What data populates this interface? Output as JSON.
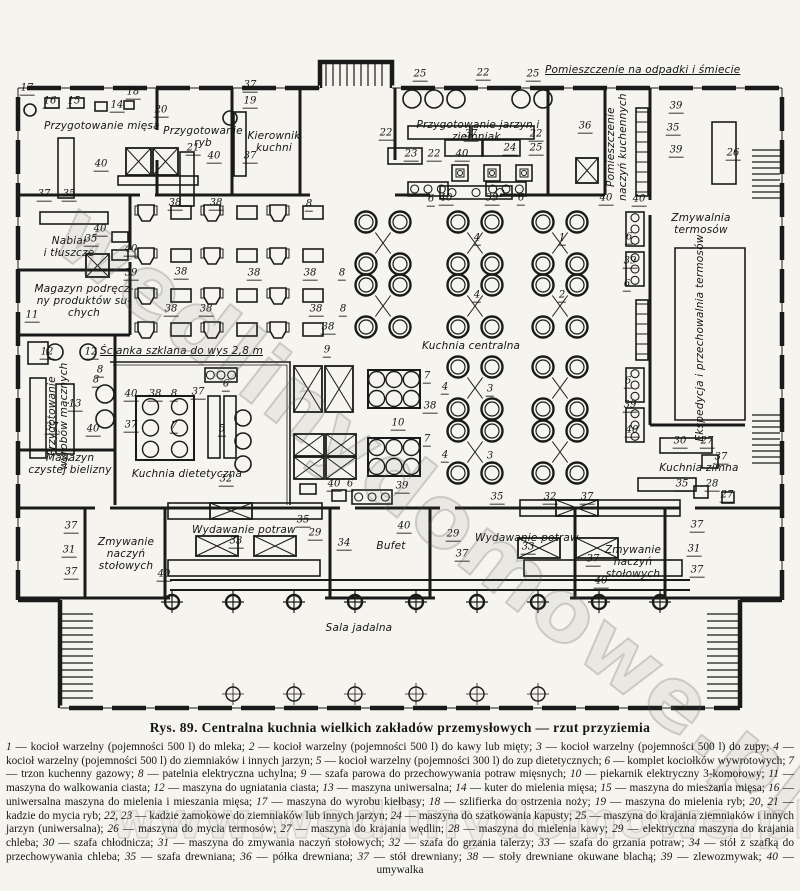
{
  "title_caption": "Rys. 89. Centralna kuchnia wielkich zakładów przemysłowych — rzut przyziemia",
  "watermarks": {
    "plan": "wedlinydomowe.pl",
    "legend": "www.wedlinydomowe.pl"
  },
  "labels": {
    "przygotowanie_miesa": "Przygotowanie mięsa",
    "przygotowanie_ryb": "Przygotowanie\nryb",
    "kierownik_kuchni": "Kierownik\nkuchni",
    "odpadki": "Pomieszczenie na odpadki i śmiecie",
    "jarzyny": "Przygotowanie jarzyn i ziemniak.",
    "naczynia_kuchenne": "Pomieszczenie\nnaczyń kuchennych",
    "zmywalnia_termosow": "Zmywalnia\ntermosów",
    "nabial": "Nabiał\ni tłuszcze",
    "magazyn_podreczny": "Magazyn podręcz-\nny produktów su-\nchych",
    "scianka": "Ścianka szklana do wys 2,8 m",
    "wyroby_maczne": "Przygotowanie\nwyrobów mącznych",
    "kuchnia_dietetyczna": "Kuchnia dietetyczna",
    "kuchnia_centralna": "Kuchnia centralna",
    "magazyn_bielizny": "Magazyn\nczystej bielizny",
    "ekspedycja": "Ekspedycja i przechowalnia termosów",
    "kuchnia_zimna": "Kuchnia zimna",
    "zmywanie_left": "Zmywanie\nnaczyń\nstołowych",
    "wydawanie_left": "Wydawanie potraw",
    "bufet": "Bufet",
    "wydawanie_right": "Wydawanie potraw",
    "zmywanie_right": "Zmywanie\nnaczyń\nstołowych",
    "sala_jadalna": "Sala jadalna"
  },
  "plan_numbers": [
    [
      "17",
      27,
      90
    ],
    [
      "16",
      50,
      103
    ],
    [
      "15",
      74,
      103
    ],
    [
      "14",
      117,
      107
    ],
    [
      "18",
      133,
      94
    ],
    [
      "20",
      161,
      112
    ],
    [
      "37",
      250,
      87
    ],
    [
      "19",
      250,
      103
    ],
    [
      "21",
      193,
      150
    ],
    [
      "40",
      101,
      166
    ],
    [
      "40",
      214,
      158
    ],
    [
      "37",
      250,
      158
    ],
    [
      "37",
      44,
      196
    ],
    [
      "35",
      69,
      196
    ],
    [
      "25",
      420,
      76
    ],
    [
      "22",
      483,
      75
    ],
    [
      "25",
      533,
      76
    ],
    [
      "22",
      386,
      135
    ],
    [
      "37",
      471,
      136
    ],
    [
      "22",
      536,
      136
    ],
    [
      "25",
      536,
      150
    ],
    [
      "23",
      411,
      156
    ],
    [
      "22",
      434,
      156
    ],
    [
      "40",
      462,
      156
    ],
    [
      "24",
      510,
      150
    ],
    [
      "36",
      585,
      128
    ],
    [
      "35",
      673,
      130
    ],
    [
      "39",
      676,
      108
    ],
    [
      "39",
      676,
      152
    ],
    [
      "26",
      733,
      155
    ],
    [
      "40",
      606,
      200
    ],
    [
      "40",
      639,
      201
    ],
    [
      "6",
      431,
      201
    ],
    [
      "40",
      446,
      200
    ],
    [
      "39",
      492,
      200
    ],
    [
      "6",
      521,
      200
    ],
    [
      "4",
      477,
      240
    ],
    [
      "4",
      477,
      297
    ],
    [
      "1",
      562,
      240
    ],
    [
      "2",
      562,
      297
    ],
    [
      "6",
      629,
      239
    ],
    [
      "39",
      630,
      263
    ],
    [
      "6",
      627,
      286
    ],
    [
      "40",
      100,
      231
    ],
    [
      "35",
      91,
      241
    ],
    [
      "40",
      131,
      251
    ],
    [
      "39",
      131,
      275
    ],
    [
      "38",
      175,
      205
    ],
    [
      "38",
      216,
      205
    ],
    [
      "8",
      309,
      206
    ],
    [
      "38",
      181,
      274
    ],
    [
      "38",
      254,
      275
    ],
    [
      "8",
      342,
      275
    ],
    [
      "38",
      310,
      275
    ],
    [
      "38",
      171,
      311
    ],
    [
      "38",
      206,
      311
    ],
    [
      "38",
      316,
      311
    ],
    [
      "8",
      343,
      311
    ],
    [
      "38",
      328,
      329
    ],
    [
      "11",
      32,
      317
    ],
    [
      "12",
      47,
      354
    ],
    [
      "12",
      91,
      354
    ],
    [
      "8",
      100,
      372
    ],
    [
      "13",
      75,
      406
    ],
    [
      "37",
      52,
      429
    ],
    [
      "40",
      93,
      431
    ],
    [
      "8",
      96,
      382
    ],
    [
      "40",
      131,
      396
    ],
    [
      "38",
      155,
      396
    ],
    [
      "8",
      174,
      396
    ],
    [
      "37",
      198,
      394
    ],
    [
      "6",
      226,
      386
    ],
    [
      "37",
      131,
      427
    ],
    [
      "7",
      174,
      428
    ],
    [
      "5",
      222,
      431
    ],
    [
      "32",
      226,
      481
    ],
    [
      "9",
      327,
      352
    ],
    [
      "7",
      427,
      378
    ],
    [
      "38",
      430,
      408
    ],
    [
      "7",
      427,
      441
    ],
    [
      "10",
      398,
      425
    ],
    [
      "4",
      445,
      389
    ],
    [
      "3",
      490,
      391
    ],
    [
      "4",
      445,
      457
    ],
    [
      "3",
      490,
      458
    ],
    [
      "40",
      334,
      486
    ],
    [
      "6",
      350,
      486
    ],
    [
      "39",
      402,
      488
    ],
    [
      "6",
      628,
      383
    ],
    [
      "39",
      630,
      407
    ],
    [
      "40",
      632,
      432
    ],
    [
      "30",
      680,
      443
    ],
    [
      "27",
      707,
      443
    ],
    [
      "37",
      721,
      459
    ],
    [
      "35",
      682,
      486
    ],
    [
      "28",
      712,
      486
    ],
    [
      "27",
      727,
      497
    ],
    [
      "37",
      71,
      528
    ],
    [
      "31",
      69,
      552
    ],
    [
      "37",
      71,
      574
    ],
    [
      "40",
      164,
      576
    ],
    [
      "35",
      303,
      522
    ],
    [
      "33",
      236,
      543
    ],
    [
      "29",
      315,
      535
    ],
    [
      "34",
      344,
      545
    ],
    [
      "40",
      404,
      528
    ],
    [
      "35",
      497,
      499
    ],
    [
      "32",
      550,
      499
    ],
    [
      "37",
      587,
      499
    ],
    [
      "29",
      453,
      536
    ],
    [
      "33",
      528,
      549
    ],
    [
      "37",
      462,
      556
    ],
    [
      "37",
      593,
      561
    ],
    [
      "40",
      601,
      583
    ],
    [
      "37",
      697,
      527
    ],
    [
      "31",
      694,
      551
    ],
    [
      "37",
      697,
      572
    ]
  ],
  "legend": {
    "entries": [
      [
        "1",
        "kocioł warzelny (pojemności 500 l) do mleka"
      ],
      [
        "2",
        "kocioł warzelny (pojemności 500 l) do kawy lub mięty"
      ],
      [
        "3",
        "kocioł warzelny (pojemności 500 l) do zupy"
      ],
      [
        "4",
        "kocioł warzelny (pojemności 500 l) do ziemniaków i innych jarzyn"
      ],
      [
        "5",
        "kocioł warzelny (pojemności 300 l) do zup dietetycznych"
      ],
      [
        "6",
        "komplet kociołków wywrotowych"
      ],
      [
        "7",
        "trzon kuchenny gazowy"
      ],
      [
        "8",
        "patelnia elektryczna uchylna"
      ],
      [
        "9",
        "szafa parowa do przechowywania potraw mięsnych"
      ],
      [
        "10",
        "piekarnik elektryczny 3-komorowy"
      ],
      [
        "11",
        "maszyna do walkowania ciasta"
      ],
      [
        "12",
        "maszyna do ugniatania ciasta"
      ],
      [
        "13",
        "maszyna uniwersalna"
      ],
      [
        "14",
        "kuter do mielenia mięsa"
      ],
      [
        "15",
        "maszyna do mieszania mięsa"
      ],
      [
        "16",
        "uniwersalna maszyna do mielenia i mieszania mięsa"
      ],
      [
        "17",
        "maszyna do wyrobu kiełbasy"
      ],
      [
        "18",
        "szlifierka do ostrzenia noży"
      ],
      [
        "19",
        "maszyna do mielenia ryb"
      ],
      [
        "20, 21",
        "kadzie do mycia ryb"
      ],
      [
        "22, 23",
        "kadzie zamokowe do ziemniaków lub innych jarzyn"
      ],
      [
        "24",
        "maszyna do szatkowania kapusty"
      ],
      [
        "25",
        "maszyna do krajania ziemniaków i innych jarzyn (uniwersalna)"
      ],
      [
        "26",
        "maszyna do mycia termosów"
      ],
      [
        "27",
        "maszyna do krajania wędlin"
      ],
      [
        "28",
        "maszyna do mielenia kawy"
      ],
      [
        "29",
        "elektryczna maszyna do krajania chleba"
      ],
      [
        "30",
        "szafa chłodnicza"
      ],
      [
        "31",
        "maszyna do zmywania naczyń stołowych"
      ],
      [
        "32",
        "szafa do grzania talerzy"
      ],
      [
        "33",
        "szafa do grzania potraw"
      ],
      [
        "34",
        "stół z szafką do przechowywania chleba"
      ],
      [
        "35",
        "szafa drewniana"
      ],
      [
        "36",
        "półka drewniana"
      ],
      [
        "37",
        "stół drewniany"
      ],
      [
        "38",
        "stoły drewniane okuwane blachą"
      ],
      [
        "39",
        "zlewozmywak"
      ],
      [
        "40",
        "umywalka"
      ]
    ]
  }
}
